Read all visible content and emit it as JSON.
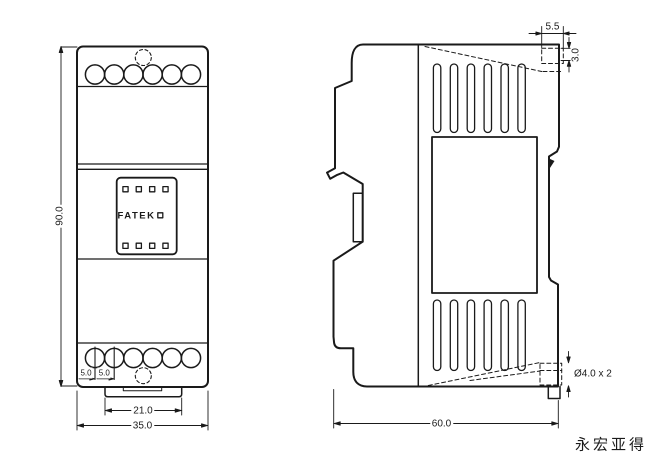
{
  "colors": {
    "background": "#ffffff",
    "line": "#1a1a1a"
  },
  "front_view": {
    "brand_label": "FATEK",
    "dim_height": "90.0",
    "dim_width": "35.0",
    "dim_tab_width": "21.0",
    "dim_pitch_left": "5.0",
    "dim_pitch_right": "5.0"
  },
  "side_view": {
    "dim_hook_depth": "5.5",
    "dim_hook_height": "3.0",
    "dim_depth": "60.0",
    "dim_mount_holes": "Ø4.0 x 2"
  },
  "footer": {
    "watermark": "永宏亚得"
  }
}
